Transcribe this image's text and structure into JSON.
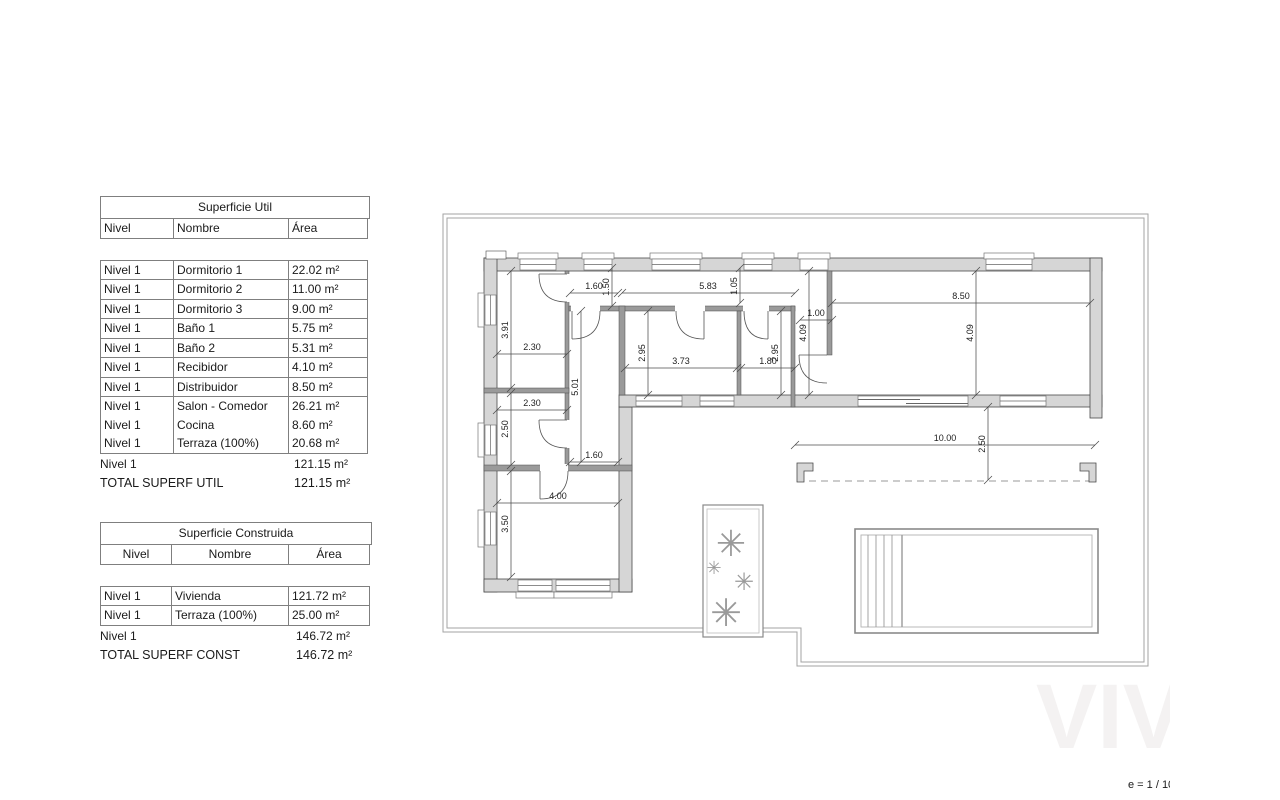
{
  "tables": {
    "util": {
      "title": "Superficie Util",
      "headers": [
        "Nivel",
        "Nombre",
        "Área"
      ],
      "rows": [
        [
          "Nivel 1",
          "Dormitorio 1",
          "22.02 m²"
        ],
        [
          "Nivel 1",
          "Dormitorio 2",
          "11.00 m²"
        ],
        [
          "Nivel 1",
          "Dormitorio 3",
          "9.00 m²"
        ],
        [
          "Nivel 1",
          "Baño 1",
          "5.75 m²"
        ],
        [
          "Nivel 1",
          "Baño 2",
          "5.31 m²"
        ],
        [
          "Nivel 1",
          "Recibidor",
          "4.10 m²"
        ],
        [
          "Nivel 1",
          "Distribuidor",
          "8.50 m²"
        ],
        [
          "Nivel 1",
          "Salon - Comedor",
          "26.21 m²"
        ],
        [
          "Nivel 1",
          "Cocina",
          "8.60 m²"
        ],
        [
          "Nivel 1",
          "Terraza (100%)",
          "20.68 m²"
        ]
      ],
      "subtotal": {
        "nivel": "Nivel 1",
        "area": "121.15 m²"
      },
      "total": {
        "label": "TOTAL SUPERF UTIL",
        "area": "121.15 m²"
      }
    },
    "construida": {
      "title": "Superficie Construida",
      "headers": [
        "Nivel",
        "Nombre",
        "Área"
      ],
      "rows": [
        [
          "Nivel 1",
          "Vivienda",
          "121.72 m²"
        ],
        [
          "Nivel 1",
          "Terraza (100%)",
          "25.00 m²"
        ]
      ],
      "subtotal": {
        "nivel": "Nivel 1",
        "area": "146.72 m²"
      },
      "total": {
        "label": "TOTAL SUPERF CONST",
        "area": "146.72 m²"
      }
    }
  },
  "plan": {
    "scale_label": "e = 1 / 100",
    "watermark": "VIV",
    "dims": [
      "1.60",
      "5.83",
      "8.50",
      "1.00",
      "2.30",
      "3.73",
      "1.80",
      "2.30",
      "1.60",
      "4.00",
      "10.00",
      "1.50",
      "1.05",
      "3.91",
      "2.95",
      "2.95",
      "4.09",
      "4.09",
      "5.01",
      "2.50",
      "3.50",
      "2.50"
    ]
  }
}
